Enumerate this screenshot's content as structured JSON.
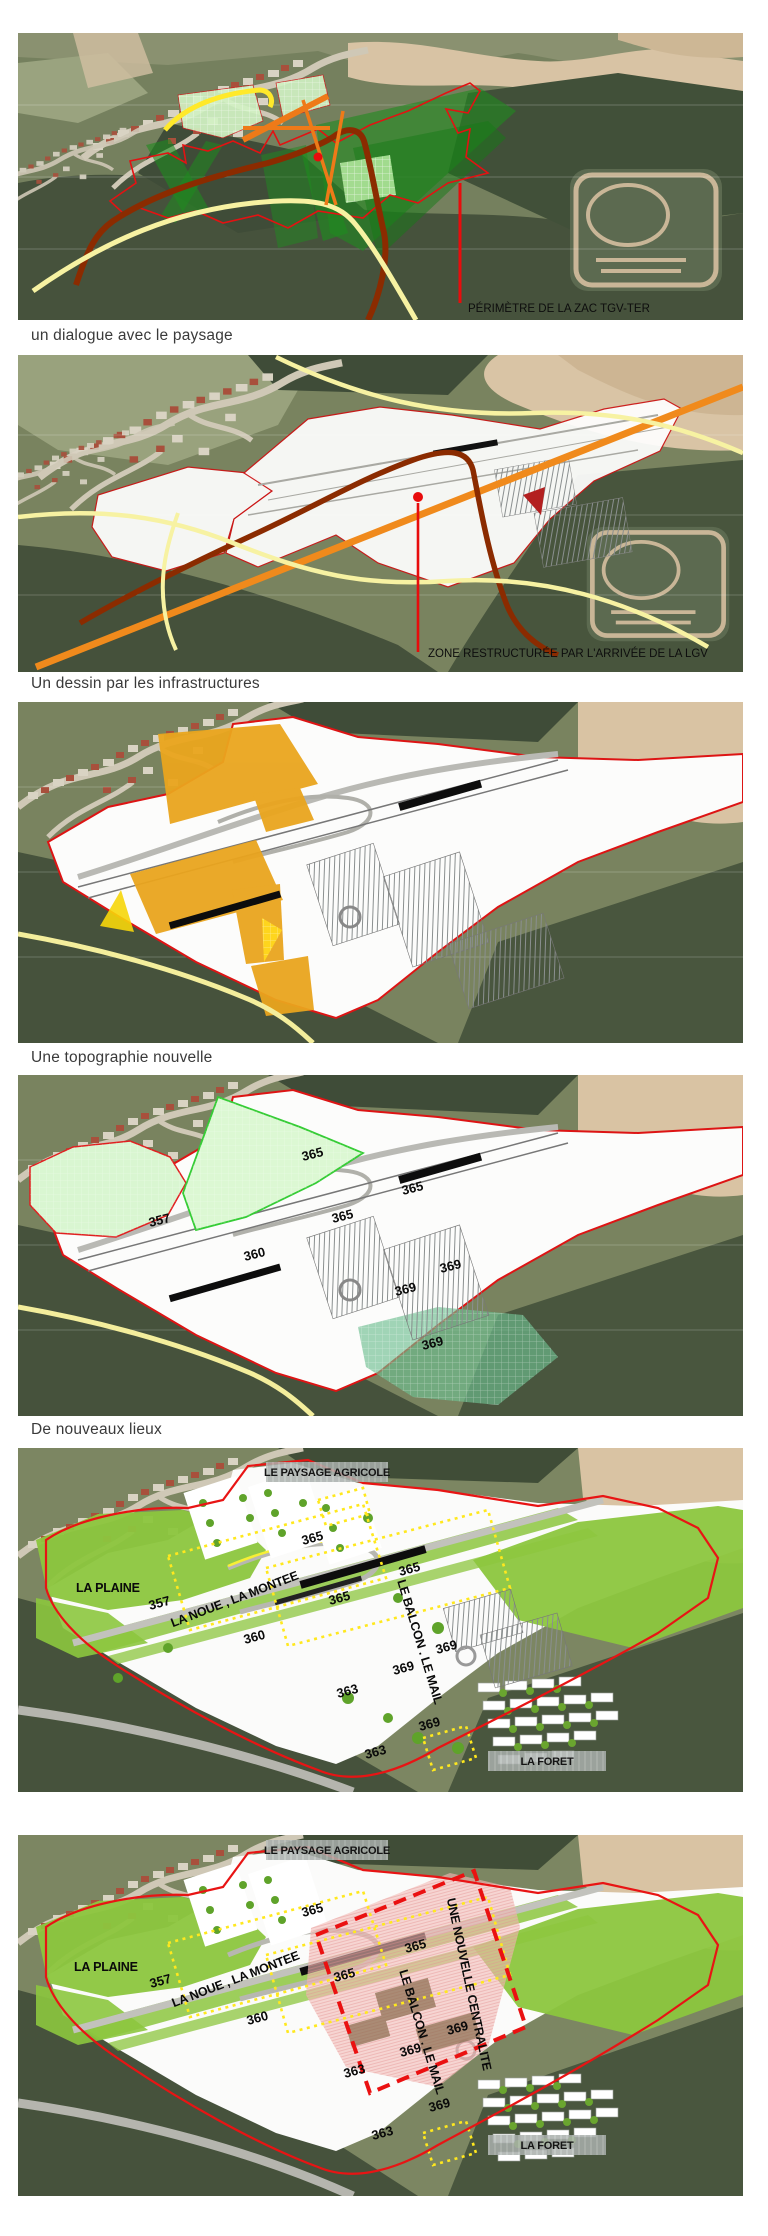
{
  "captions": {
    "c1": "un dialogue avec le paysage",
    "c2": "Un dessin par les infrastructures",
    "c3": "Une topographie nouvelle",
    "c4": "De nouveaux lieux"
  },
  "map1": {
    "callout": "PÉRIMÈTRE DE LA ZAC TGV-TER"
  },
  "map2": {
    "callout": "ZONE RESTRUCTURÉE PAR L'ARRIVÉE DE LA LGV"
  },
  "map4": {
    "elev": [
      "365",
      "365",
      "365",
      "357",
      "360",
      "369",
      "369",
      "369"
    ]
  },
  "map5": {
    "zone1": "LE PAYSAGE AGRICOLE",
    "zone2": "LA FORET",
    "plaine": "LA PLAINE",
    "noue": "LA NOUE , LA MONTEE",
    "balcon": "LE BALCON . LE MAIL",
    "elev": [
      "357",
      "365",
      "365",
      "365",
      "360",
      "369",
      "369",
      "369",
      "363",
      "363"
    ]
  },
  "map6": {
    "zone1": "LE PAYSAGE AGRICOLE",
    "zone2": "LA FORET",
    "plaine": "LA PLAINE",
    "noue": "LA NOUE , LA MONTEE",
    "balcon": "LE BALCON . LE MAIL",
    "centralite": "UNE NOUVELLE CENTRALITE",
    "elev": [
      "357",
      "365",
      "365",
      "365",
      "360",
      "369",
      "369",
      "369",
      "363",
      "363"
    ]
  },
  "colors": {
    "zac_perimeter_red": "#e31212",
    "lgv_orange": "#f08a1c",
    "road_brown": "#8b2b00",
    "road_yellow": "#f7f2a2",
    "program_amber": "#eaa51e",
    "landscape_green": "#8cc63e",
    "zone_dotted_yellow": "#ffe81e",
    "centrality_pink": "#f3bcb8",
    "centrality_dashed_red": "#ea1111"
  }
}
